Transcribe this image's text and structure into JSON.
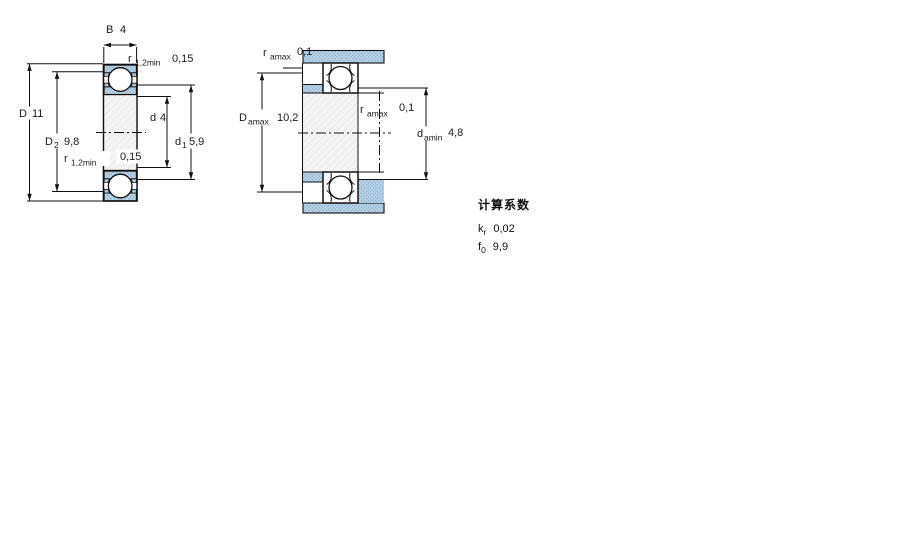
{
  "fig1": {
    "b": {
      "base": "B",
      "value": "4"
    },
    "r12_top": {
      "base": "r",
      "sub": "1,2min",
      "value": "0,15"
    },
    "D": {
      "base": "D",
      "value": "11"
    },
    "D2": {
      "base": "D",
      "sub": "2",
      "value": "9,8"
    },
    "d": {
      "base": "d",
      "value": "4"
    },
    "d1": {
      "base": "d",
      "sub": "1",
      "value": "5,9"
    },
    "r12_bottom": {
      "base": "r",
      "sub": "1,2min",
      "value": "0,15"
    }
  },
  "fig2": {
    "ra_top": {
      "base": "r",
      "sub": "amax",
      "value": "0,1"
    },
    "ra_mid": {
      "base": "r",
      "sub": "amax",
      "value": "0,1"
    },
    "Damax": {
      "base": "D",
      "sub": "amax",
      "value": "10,2"
    },
    "damin": {
      "base": "d",
      "sub": "amin",
      "value": "4,8"
    }
  },
  "factors": {
    "title": "计算系数",
    "rows": [
      {
        "base": "k",
        "sub": "r",
        "value": "0,02"
      },
      {
        "base": "f",
        "sub": "0",
        "value": "9,9"
      }
    ]
  },
  "colors": {
    "section_fill_blue": "#b7d0e5",
    "section_dot_blue": "#88b0d0",
    "bore_fill": "#f4f4f4",
    "line": "#000000"
  }
}
